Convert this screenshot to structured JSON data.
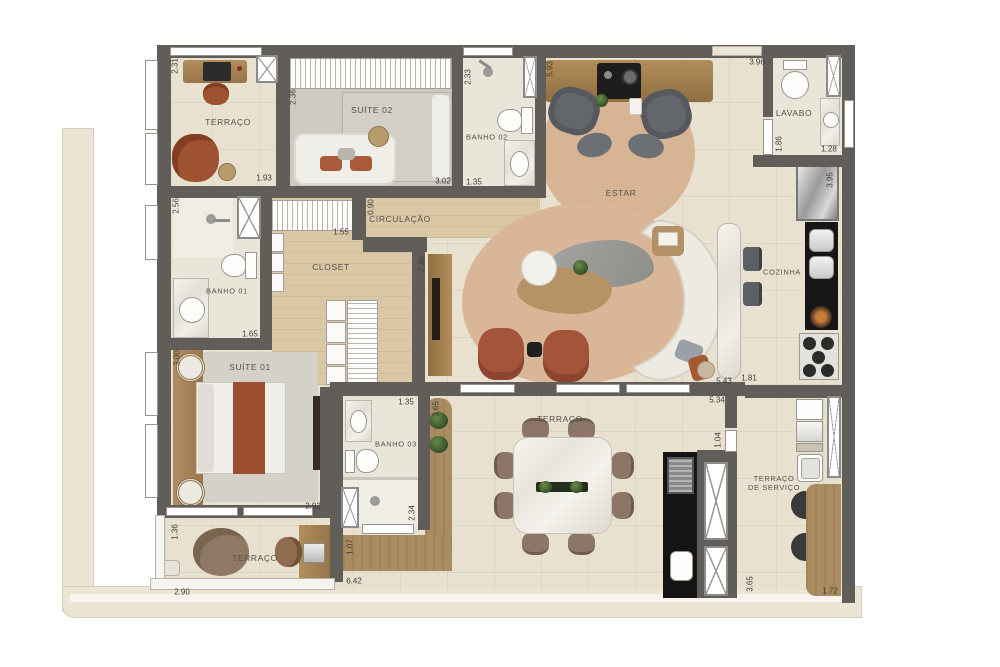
{
  "plan": {
    "rooms": {
      "terraco_top": "TERRAÇO",
      "suite02": "SUÍTE 02",
      "banho02": "BANHO 02",
      "estar": "ESTAR",
      "lavabo": "LAVABO",
      "circulacao": "CIRCULAÇÃO",
      "closet": "CLOSET",
      "banho01": "BANHO 01",
      "suite01": "SUÍTE 01",
      "cozinha": "COZINHA",
      "banho03": "BANHO 03",
      "terraco_dining": "TERRAÇO",
      "terraco_servico_line1": "TERRAÇO",
      "terraco_servico_line2": "DE SERVIÇO",
      "terraco_bottom": "TERRAÇO"
    },
    "dims": [
      "2.31",
      "1.93",
      "2.36",
      "3.02",
      "2.33",
      "1.35",
      "5.93",
      "3.96",
      "1.86",
      "1.28",
      "3.95",
      "2.56",
      "0.90",
      "1.55",
      "2.40",
      "1.65",
      "3.00",
      "2.92",
      "1.35",
      "2.34",
      "1.36",
      "2.90",
      "6.42",
      "1.07",
      "3.65",
      "5.43",
      "1.81",
      "5.34",
      "1.04",
      "3.65",
      "1.72"
    ],
    "colors": {
      "wall": "#615e5a",
      "floor_tile": "#e8e1cf",
      "wood_floor": "#d9c7a6",
      "wood_deck": "#ab8c61",
      "rug_tan": "#d9b697",
      "carpet_gray": "#d4d1c8",
      "accent_rust": "#a4543a",
      "counter_black": "#161616",
      "sofa_cream": "#edeae2"
    }
  }
}
